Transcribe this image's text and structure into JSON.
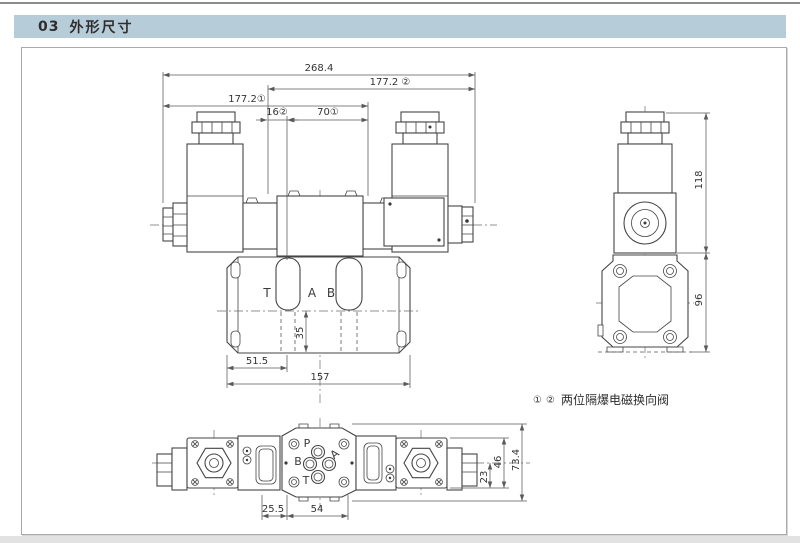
{
  "header": {
    "number": "03",
    "title": "外形尺寸"
  },
  "drawing": {
    "front_view": {
      "dim_overall": "268.4",
      "dim_177_2_b": "177.2 ②",
      "dim_177_2_a": "177.2①",
      "dim_16": "16②",
      "dim_70": "70①",
      "dim_51_5": "51.5",
      "dim_157": "157",
      "dim_35": "35",
      "port_t": "T",
      "port_a": "A",
      "port_b": "B"
    },
    "side_view": {
      "dim_118": "118",
      "dim_96": "96"
    },
    "bottom_view": {
      "dim_25_5": "25.5",
      "dim_54": "54",
      "dim_23": "23",
      "dim_46": "46",
      "dim_73_4": "73.4",
      "port_p": "P",
      "port_a": "A",
      "port_b": "B",
      "port_t": "T"
    },
    "note": {
      "marker_1": "①",
      "marker_2": "②",
      "text": "两位隔爆电磁换向阀"
    }
  },
  "colors": {
    "header_bg": "#b7ccd9",
    "line": "#454545",
    "dim": "#5a5a5a"
  }
}
